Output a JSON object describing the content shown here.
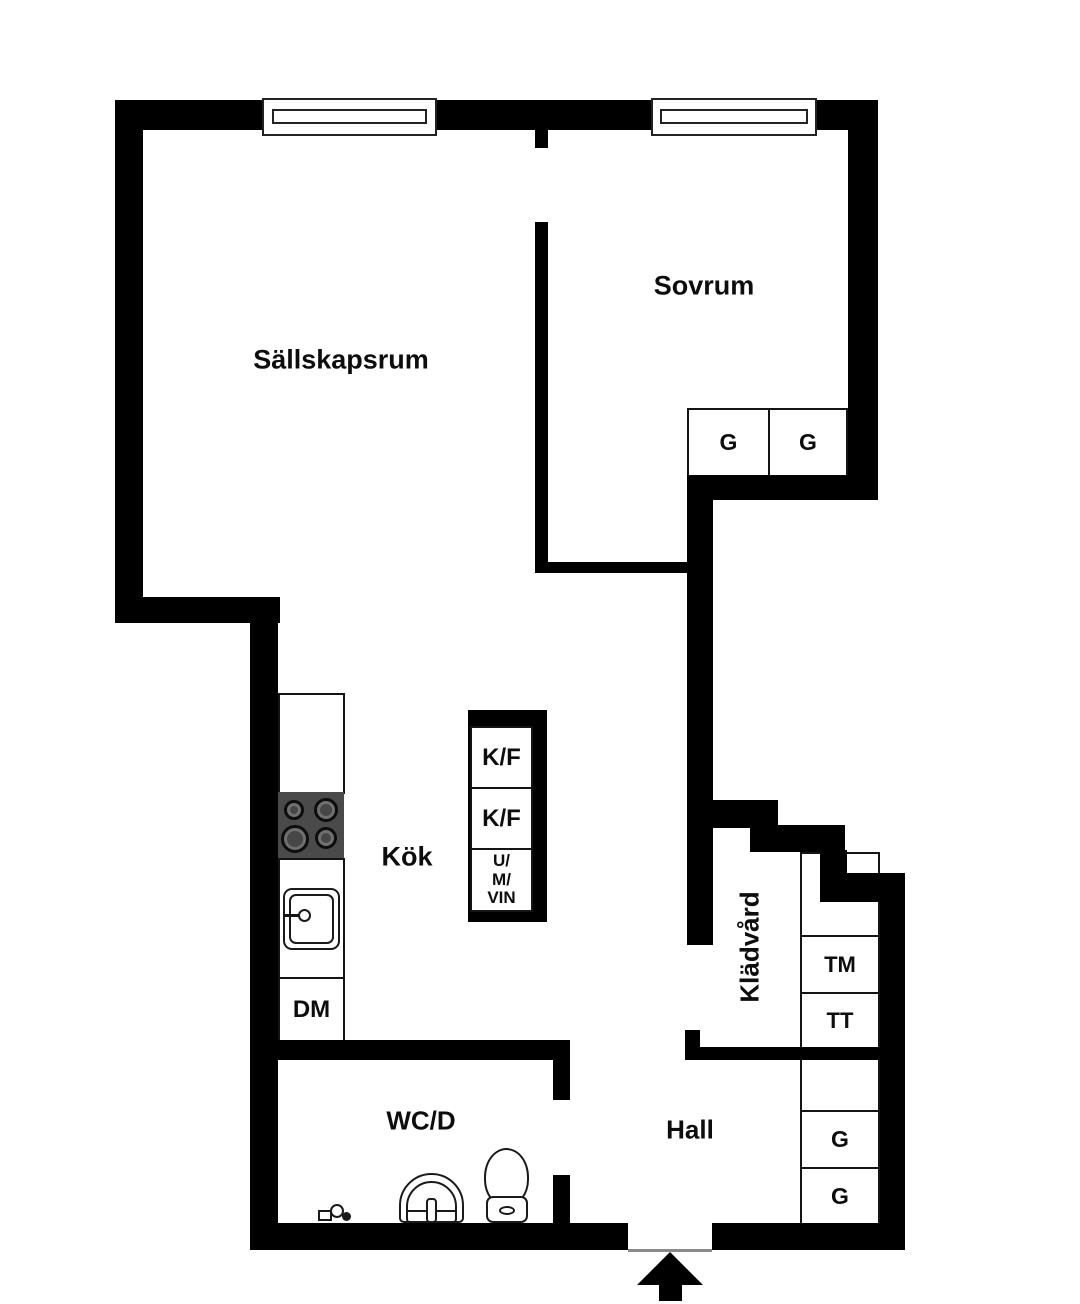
{
  "rooms": {
    "living": "Sällskapsrum",
    "bedroom": "Sovrum",
    "kitchen": "Kök",
    "bathroom": "WC/D",
    "hall": "Hall",
    "laundry": "Klädvård"
  },
  "units": {
    "bedroom_wardrobe_1": "G",
    "bedroom_wardrobe_2": "G",
    "fridge_freezer_1": "K/F",
    "fridge_freezer_2": "K/F",
    "oven_micro_wine": "U/\nM/\nVIN",
    "dishwasher": "DM",
    "washing_machine": "TM",
    "tumble_dryer": "TT",
    "hall_wardrobe_1": "G",
    "hall_wardrobe_2": "G"
  },
  "colors": {
    "wall": "#000000",
    "background": "#ffffff",
    "stove_top": "#4a4a4a",
    "thin_line": "#141414"
  }
}
